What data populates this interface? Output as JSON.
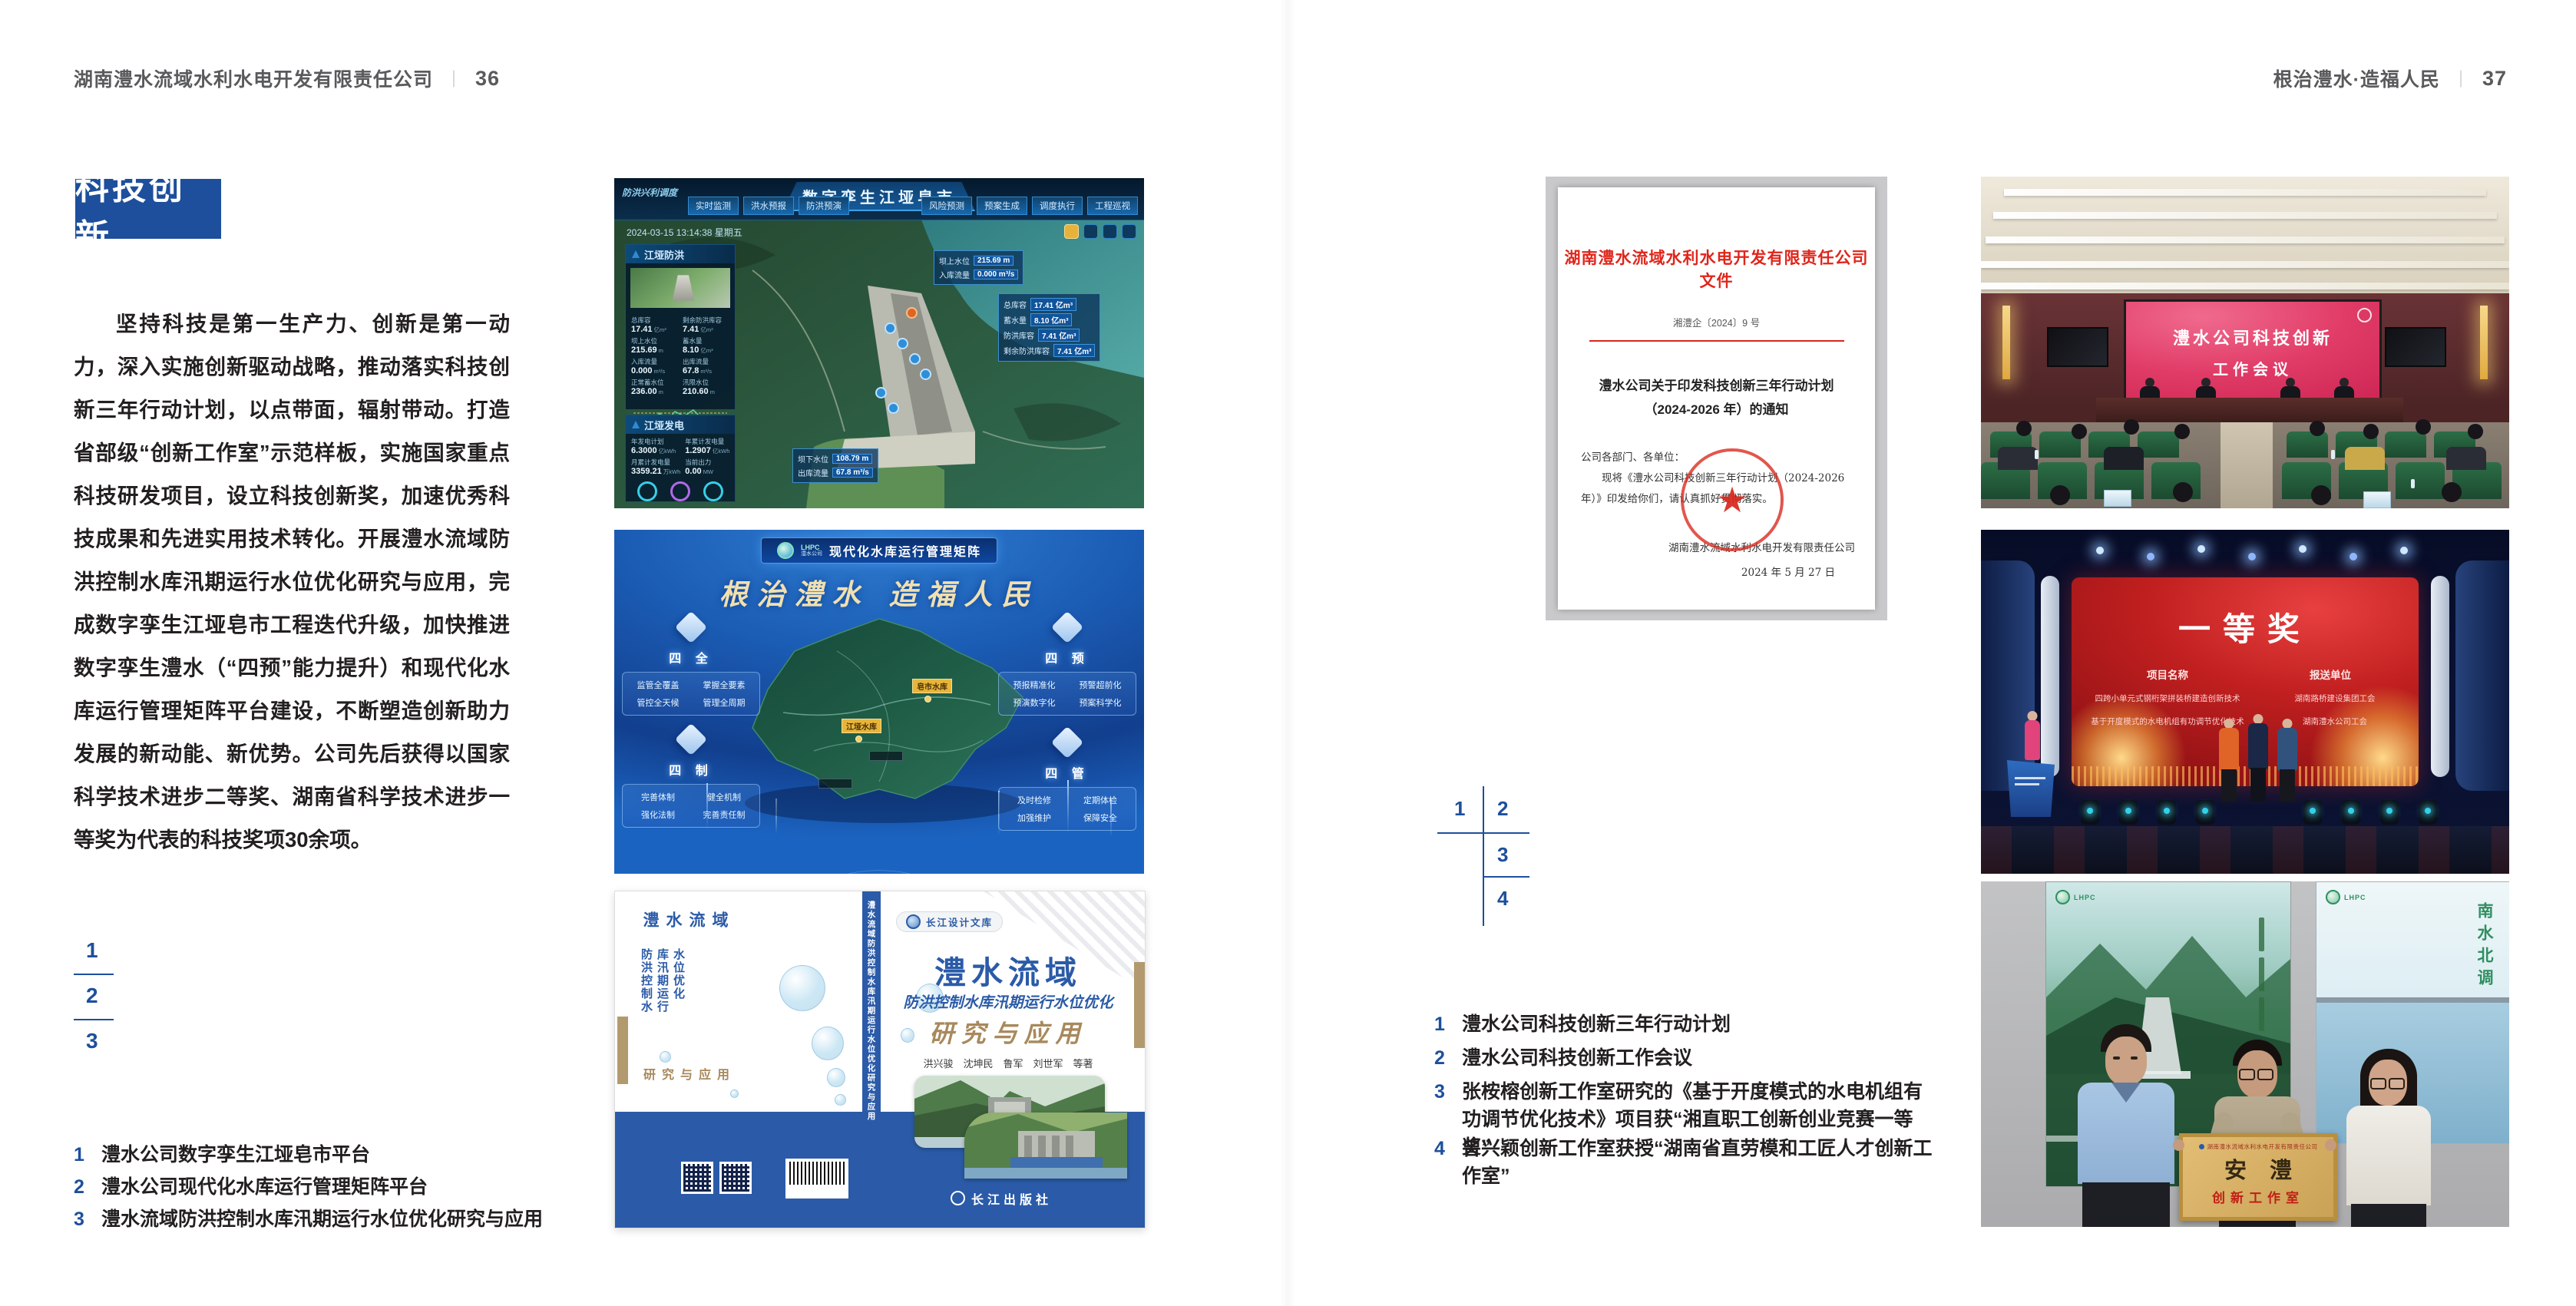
{
  "page": {
    "left_header": "湖南澧水流域水利水电开发有限责任公司",
    "left_page_no": "36",
    "right_header": "根治澧水·造福人民",
    "right_page_no": "37",
    "divider": "｜"
  },
  "left": {
    "section_title": "科技创新",
    "body": "坚持科技是第一生产力、创新是第一动力，深入实施创新驱动战略，推动落实科技创新三年行动计划，以点带面，辐射带动。打造省部级“创新工作室”示范样板，实施国家重点科技研发项目，设立科技创新奖，加速优秀科技成果和先进实用技术转化。开展澧水流域防洪控制水库汛期运行水位优化研究与应用，完成数字孪生江垭皂市工程迭代升级，加快推进数字孪生澧水（“四预”能力提升）和现代化水库运行管理矩阵平台建设，不断塑造创新助力发展的新动能、新优势。公司先后获得以国家科学技术进步二等奖、湖南省科学技术进步一等奖为代表的科技奖项30余项。",
    "fig_nums": [
      "1",
      "2",
      "3"
    ],
    "captions": [
      {
        "num": "1",
        "text": "澧水公司数字孪生江垭皂市平台"
      },
      {
        "num": "2",
        "text": "澧水公司现代化水库运行管理矩阵平台"
      },
      {
        "num": "3",
        "text": "澧水流域防洪控制水库汛期运行水位优化研究与应用"
      }
    ]
  },
  "right": {
    "fig_nums": [
      "1",
      "2",
      "3",
      "4"
    ],
    "captions": [
      {
        "num": "1",
        "text": "澧水公司科技创新三年行动计划"
      },
      {
        "num": "2",
        "text": "澧水公司科技创新工作会议"
      },
      {
        "num": "3",
        "text": "张桉榕创新工作室研究的《基于开度模式的水电机组有功调节优化技术》项目获“湘直职工创新创业竞赛一等奖”"
      },
      {
        "num": "4",
        "text": "曾兴颖创新工作室获授“湖南省直劳模和工匠人才创新工作室”"
      }
    ]
  },
  "dashboard": {
    "title": "数字孪生江垭皂市",
    "module": "防洪兴利调度",
    "tabs_left": [
      "实时监测",
      "洪水预报",
      "防洪预演"
    ],
    "tabs_right": [
      "风险预测",
      "预案生成",
      "调度执行",
      "工程巡视"
    ],
    "timestamp": "2024-03-15 13:14:38 星期五",
    "panel_flood": {
      "title": "江垭防洪",
      "stats": [
        {
          "l": "总库容",
          "v": "17.41",
          "u": "亿m³"
        },
        {
          "l": "剩余防洪库容",
          "v": "7.41",
          "u": "亿m³"
        },
        {
          "l": "坝上水位",
          "v": "215.69",
          "u": "m"
        },
        {
          "l": "蓄水量",
          "v": "8.10",
          "u": "亿m³"
        },
        {
          "l": "入库流量",
          "v": "0.000",
          "u": "m³/s"
        },
        {
          "l": "出库流量",
          "v": "67.8",
          "u": "m³/s"
        },
        {
          "l": "正常蓄水位",
          "v": "236.00",
          "u": "m"
        },
        {
          "l": "汛限水位",
          "v": "210.60",
          "u": "m"
        }
      ]
    },
    "panel_power": {
      "title": "江垭发电",
      "stats": [
        {
          "l": "年发电计划",
          "v": "6.3000",
          "u": "亿kWh"
        },
        {
          "l": "年累计发电量",
          "v": "1.2907",
          "u": "亿kWh"
        },
        {
          "l": "月累计发电量",
          "v": "3359.21",
          "u": "万kWh"
        },
        {
          "l": "当前出力",
          "v": "0.00",
          "u": "MW"
        },
        {
          "l": "发电流量",
          "v": "0.00",
          "u": "m³/s"
        },
        {
          "l": "弃水流量",
          "v": "0.00",
          "u": "m³/s"
        }
      ]
    },
    "callout_up": [
      {
        "l": "坝上水位",
        "v": "215.69 m"
      },
      {
        "l": "入库流量",
        "v": "0.000 m³/s"
      }
    ],
    "callout_res": [
      {
        "l": "总库容",
        "v": "17.41 亿m³"
      },
      {
        "l": "蓄水量",
        "v": "8.10 亿m³"
      },
      {
        "l": "防洪库容",
        "v": "7.41 亿m³"
      },
      {
        "l": "剩余防洪库容",
        "v": "7.41 亿m³"
      }
    ],
    "callout_down": [
      {
        "l": "坝下水位",
        "v": "108.79 m"
      },
      {
        "l": "出库流量",
        "v": "67.8 m³/s"
      }
    ]
  },
  "matrix": {
    "logo_abbr": "LHPC",
    "logo_name": "澧水公司",
    "title": "现代化水库运行管理矩阵",
    "slogan": "根治澧水  造福人民",
    "corners": [
      {
        "name": "四 全",
        "items": [
          "监管全覆盖",
          "掌握全要素",
          "管控全天候",
          "管理全周期"
        ]
      },
      {
        "name": "四 预",
        "items": [
          "预报精准化",
          "预警超前化",
          "预演数字化",
          "预案科学化"
        ]
      },
      {
        "name": "四 制",
        "items": [
          "完善体制",
          "健全机制",
          "强化法制",
          "完善责任制"
        ]
      },
      {
        "name": "四 管",
        "items": [
          "及时检修",
          "定期体检",
          "加强维护",
          "保障安全"
        ]
      }
    ],
    "markers": [
      "皂市水库",
      "江垭水库"
    ]
  },
  "book": {
    "series": "长江设计文库",
    "title": "澧水流域",
    "subtitle": "防洪控制水库汛期运行水位优化",
    "subtitle2": "研究与应用",
    "authors": "洪兴骏　沈坤民　鲁军　刘世军　等著",
    "publisher": "长江出版社",
    "spine": "澧水流域防洪控制水库汛期运行水位优化研究与应用",
    "back_line1": "澧水流域",
    "back_line2": "防洪控制水库汛期运行水位优化",
    "back_line3": "研究与应用"
  },
  "doc": {
    "header": "湖南澧水流域水利水电开发有限责任公司文件",
    "doc_no": "湘澧企〔2024〕9 号",
    "title1": "澧水公司关于印发科技创新三年行动计划",
    "title2": "（2024-2026 年）的通知",
    "salute": "公司各部门、各单位：",
    "body": "现将《澧水公司科技创新三年行动计划（2024-2026 年）》印发给你们，请认真抓好贯彻落实。",
    "signer": "湖南澧水流域水利水电开发有限责任公司",
    "date": "2024 年 5 月 27 日"
  },
  "meeting": {
    "line1": "澧水公司科技创新",
    "line2": "工作会议"
  },
  "award": {
    "headline": "一等奖",
    "col1": "项目名称",
    "col2": "报送单位",
    "p1": "四跨小单元式钢桁架拼装桥建造创新技术",
    "p2": "基于开度模式的水电机组有功调节优化技术",
    "u1": "湖南路桥建设集团工会",
    "u2": "湖南澧水公司工会"
  },
  "group": {
    "plaque_org": "湖南澧水流域水利水电开发有限责任公司",
    "plaque_name": "安澧",
    "plaque_sub": "创新工作室",
    "poster_right_caption": "南水北调",
    "logo_abbr": "LHPC"
  }
}
